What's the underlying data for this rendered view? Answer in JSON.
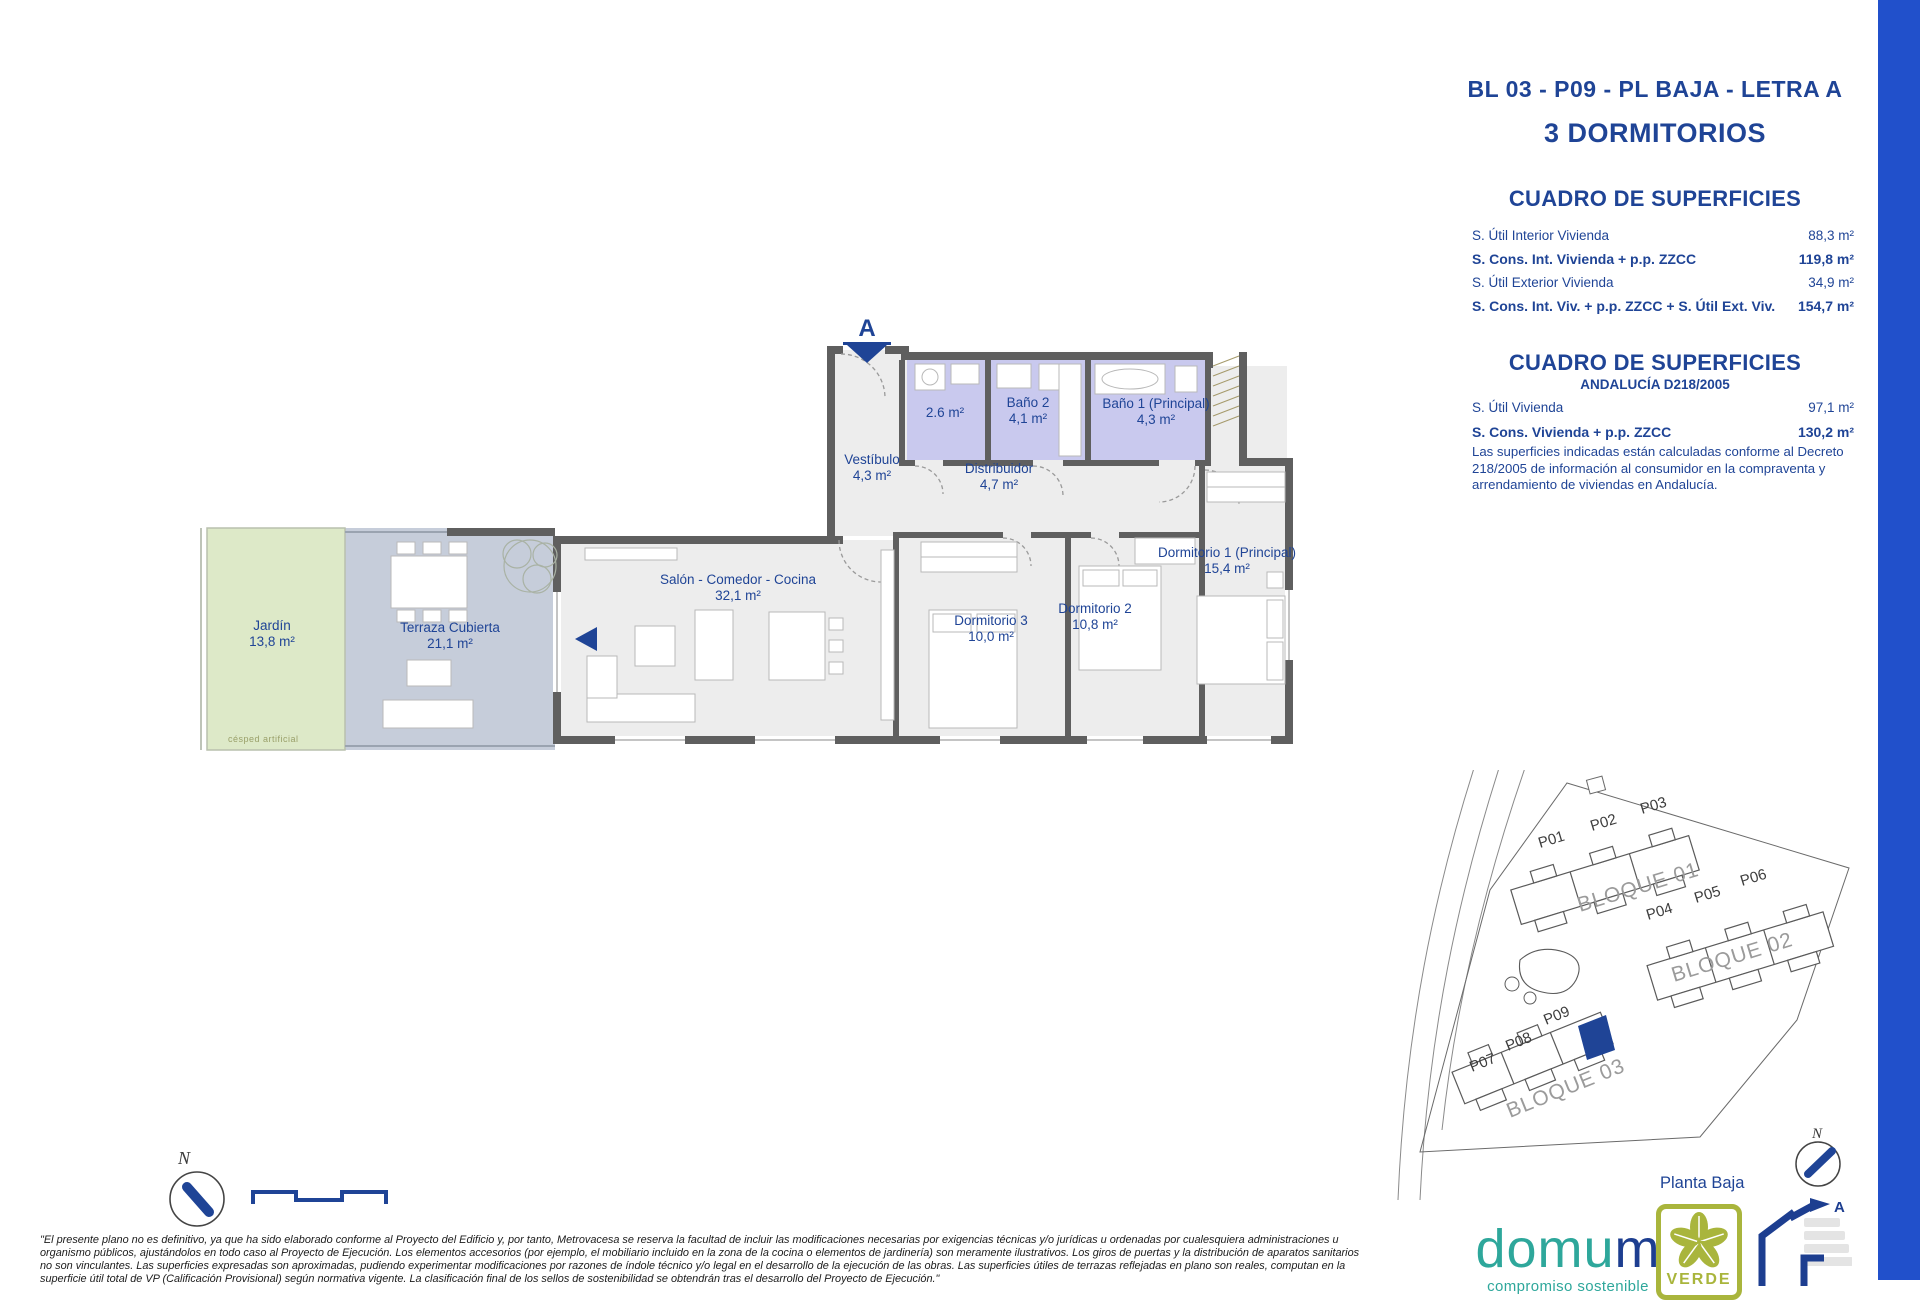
{
  "header": {
    "unit_title": "BL 03 - P09 - PL BAJA - LETRA A",
    "subtitle": "3 DORMITORIOS"
  },
  "surface_table": {
    "title": "CUADRO DE SUPERFICIES",
    "rows": [
      {
        "label": "S. Útil Interior Vivienda",
        "value": "88,3 m²"
      },
      {
        "label": "S. Cons. Int. Vivienda + p.p. ZZCC",
        "value": "119,8 m²"
      },
      {
        "label": "S. Útil Exterior Vivienda",
        "value": "34,9 m²"
      },
      {
        "label": "S. Cons. Int. Viv. + p.p. ZZCC + S. Útil Ext. Viv.",
        "value": "154,7 m²"
      }
    ]
  },
  "andalucia_table": {
    "title": "CUADRO DE SUPERFICIES",
    "subtitle": "ANDALUCÍA D218/2005",
    "rows": [
      {
        "label": "S. Útil Vivienda",
        "value": "97,1 m²"
      },
      {
        "label": "S. Cons. Vivienda + p.p. ZZCC",
        "value": "130,2 m²"
      }
    ],
    "note": "Las superficies indicadas están calculadas conforme al Decreto 218/2005 de información al consumidor en la compraventa y arrendamiento de viviendas en Andalucía."
  },
  "floorplan": {
    "section_marker": "A",
    "garden_note": "césped artificial",
    "rooms": [
      {
        "name": "Jardín",
        "area": "13,8 m²"
      },
      {
        "name": "Terraza Cubierta",
        "area": "21,1 m²"
      },
      {
        "name": "Salón - Comedor - Cocina",
        "area": "32,1 m²"
      },
      {
        "name": "Vestíbulo",
        "area": "4,3 m²"
      },
      {
        "name": "Distribuidor",
        "area": "4,7 m²"
      },
      {
        "name": "",
        "area": "2.6 m²"
      },
      {
        "name": "Baño 2",
        "area": "4,1 m²"
      },
      {
        "name": "Baño 1 (Principal)",
        "area": "4,3 m²"
      },
      {
        "name": "Dormitorio 3",
        "area": "10,0 m²"
      },
      {
        "name": "Dormitorio 2",
        "area": "10,8 m²"
      },
      {
        "name": "Dormitorio 1 (Principal)",
        "area": "15,4 m²"
      }
    ]
  },
  "siteplan": {
    "units": [
      "P01",
      "P02",
      "P03",
      "P04",
      "P05",
      "P06",
      "P07",
      "P08",
      "P09"
    ],
    "blocks": [
      "BLOQUE 01",
      "BLOQUE 02",
      "BLOQUE 03"
    ],
    "floor_label": "Planta Baja",
    "north_label": "N"
  },
  "compass": {
    "north_label": "N"
  },
  "disclaimer_lines": [
    "\"El presente plano no es definitivo, ya que ha sido elaborado conforme al Proyecto del Edificio y, por tanto, Metrovacesa se reserva la facultad de incluir las modificaciones necesarias por exigencias técnicas y/o jurídicas u ordenadas por cualesquiera administraciones u",
    "organismo públicos, ajustándolos en todo caso al Proyecto de Ejecución. Los elementos accesorios (por ejemplo, el mobiliario incluido en la zona de la cocina o elementos de jardinería) son meramente ilustrativos. Los giros de puertas y la distribución de aparatos sanitarios",
    "no son vinculantes. Las superficies expresadas son aproximadas, pudiendo experimentar modificaciones por razones de índole técnico y/o legal en el desarrollo de la ejecución de las obras. Las superficies útiles de terrazas reflejadas en plano son reales, computan en la",
    "superficie útil total de VP (Calificación Provisional) según normativa vigente. La clasificación final de los sellos de sostenibilidad se obtendrán tras el desarrollo del Proyecto de Ejecución.\""
  ],
  "branding": {
    "logo_part1": "domu",
    "logo_part2": "m",
    "tagline": "compromiso sostenible",
    "cert_label": "VERDE",
    "energy_rating": "A"
  },
  "colors": {
    "accent": "#1f4496",
    "sidebar": "#2150cb",
    "wall": "#5f5f5f",
    "floor": "#ededed",
    "bath": "#c9c9ee",
    "terrace": "#c6cdda",
    "garden": "#dde9c8",
    "teal": "#2ea79b",
    "olive": "#a9b53c"
  }
}
